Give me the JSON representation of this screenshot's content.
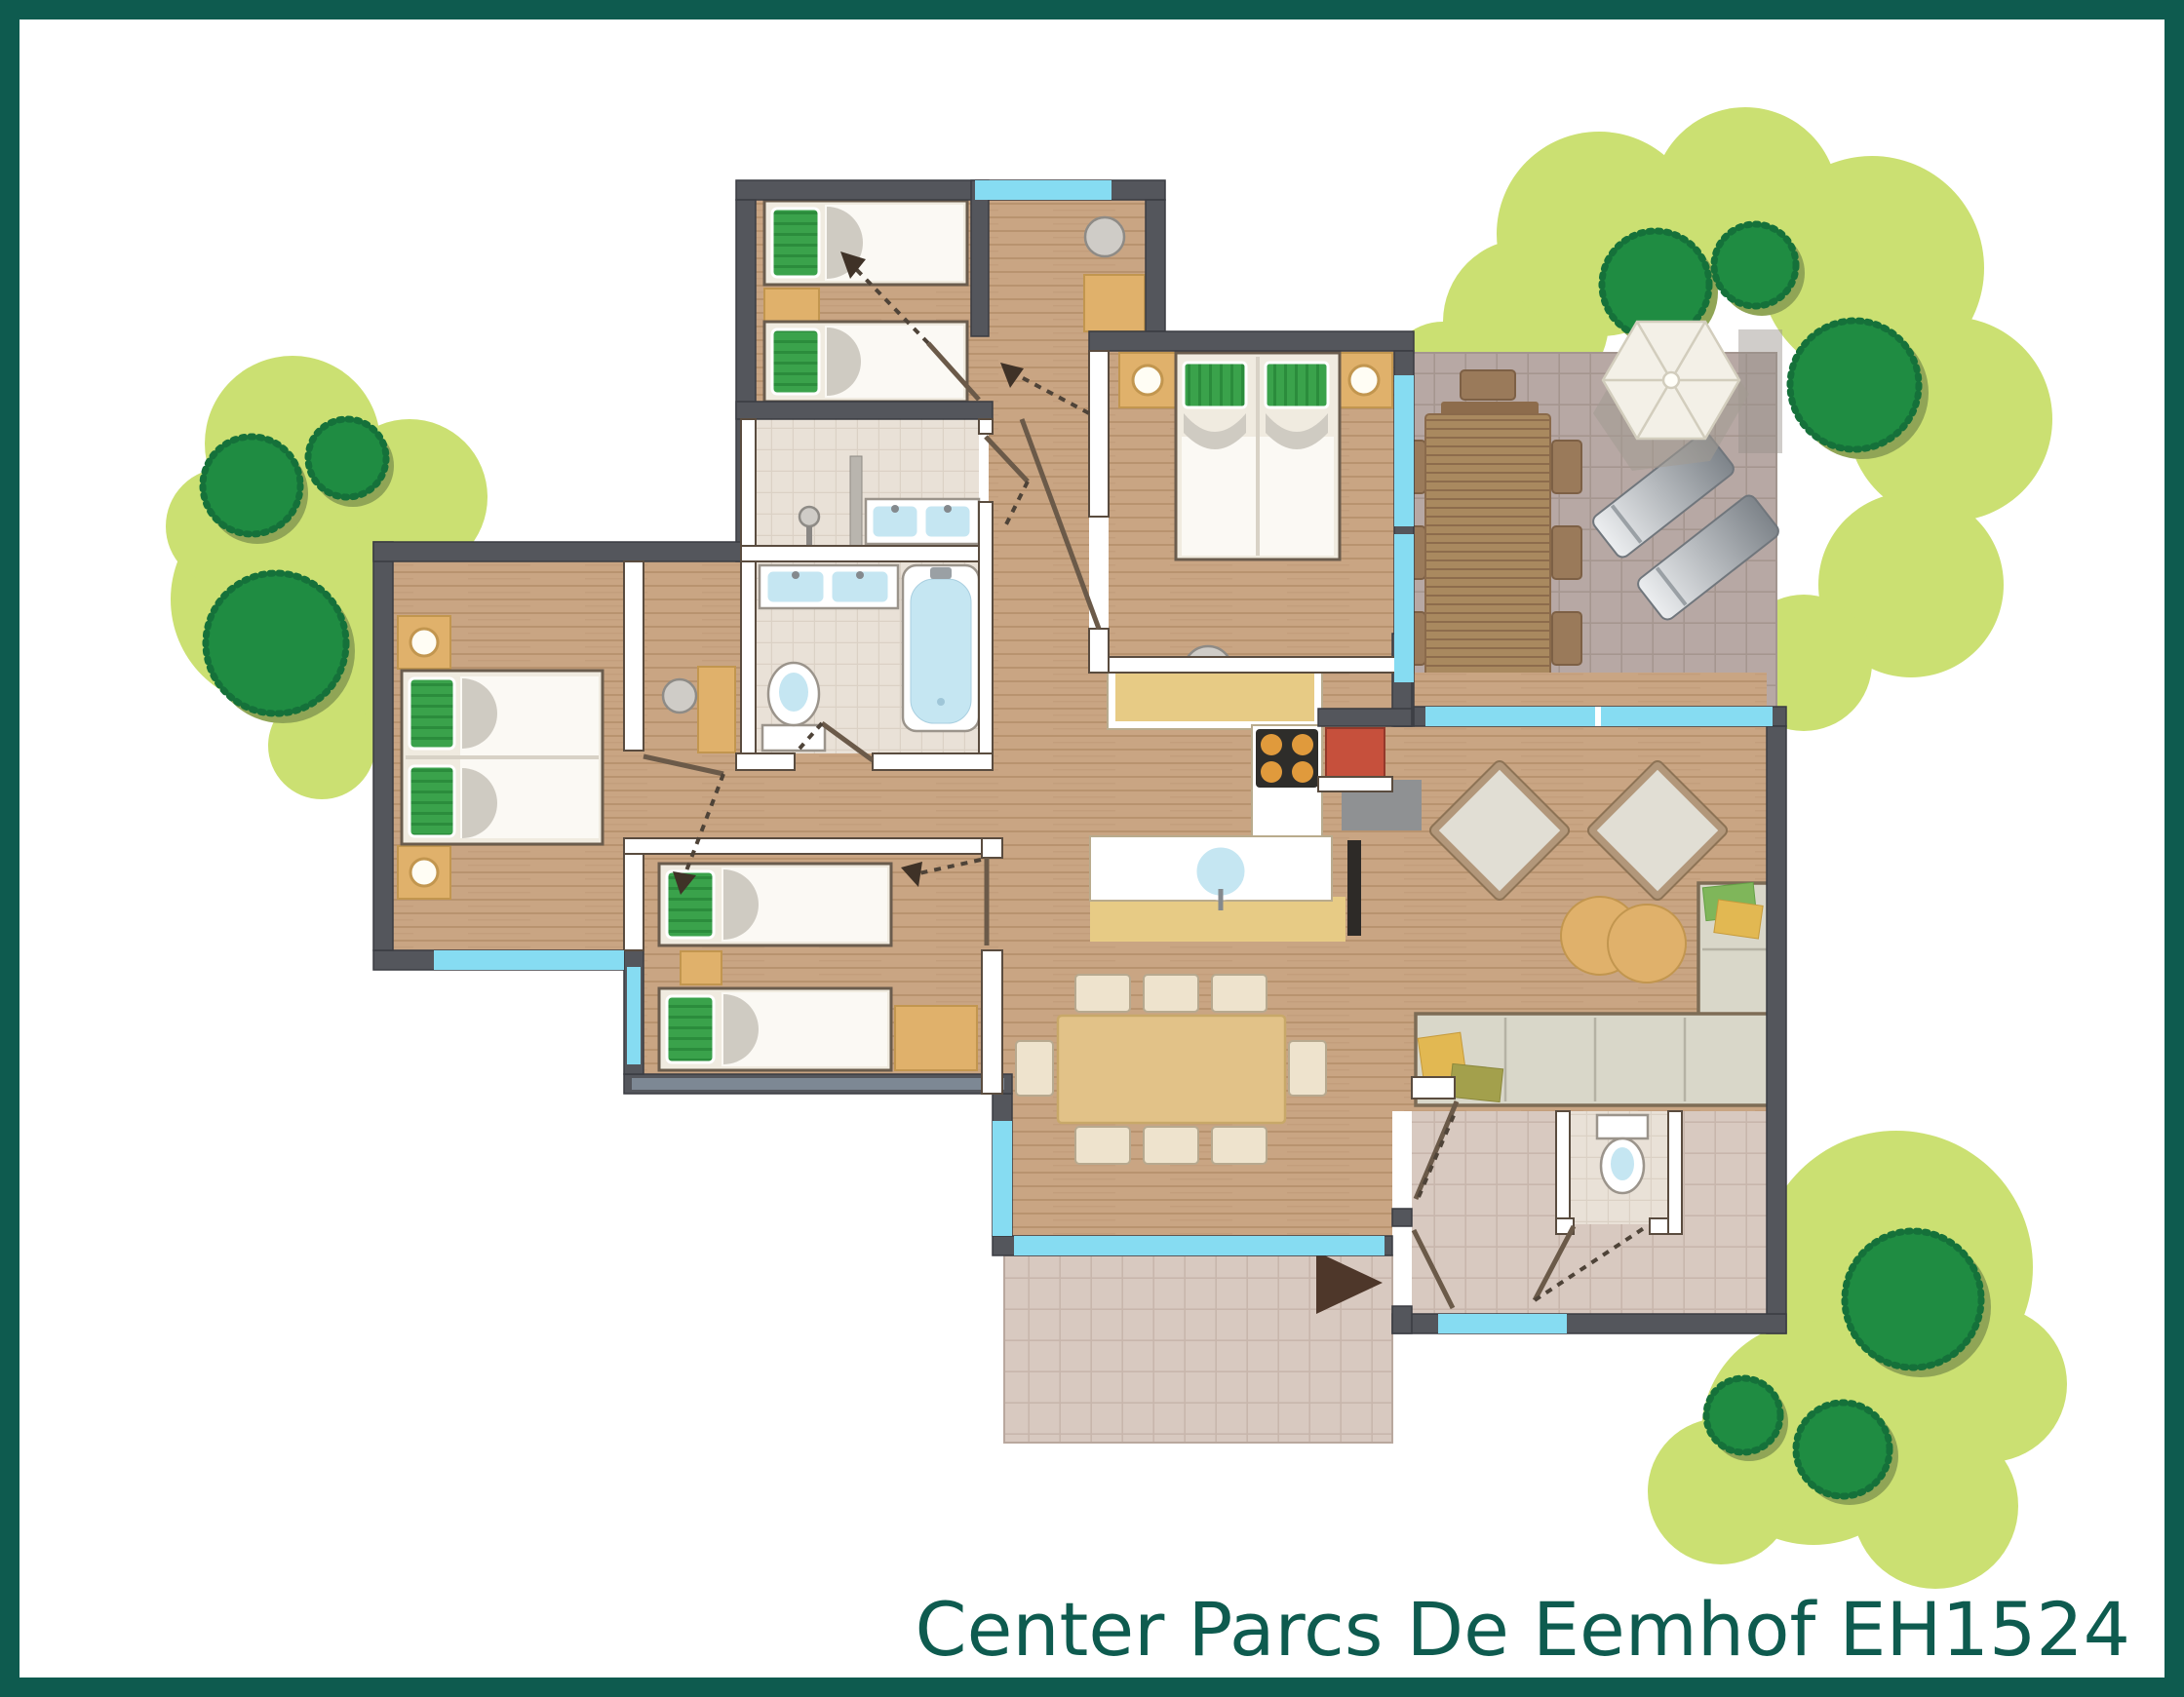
{
  "title": "Center Parcs De Eemhof EH1524",
  "colors": {
    "teal": "#0e5b4f",
    "wall_dark": "#54565c",
    "wall_line": "#3a3c42",
    "wall_white_line": "#5a4c3f",
    "glass": "#86dcf2",
    "wood": "#c9a583",
    "wood_line": "#b8936f",
    "tile_terrace": "#b7a8a4",
    "tile_terrace_line": "#a5968f",
    "tile_hall": "#d8c9c0",
    "tile_hall_line": "#c8b6ac",
    "tile_bath": "#e9e1d7",
    "tile_bath_line": "#dbd1c5",
    "green_light": "#cbe072",
    "green_dark": "#1f8c42",
    "green_edge": "#15713a",
    "green_shadow": "#90a556",
    "bed": "#f0ebe0",
    "bed_line": "#6a5c4d",
    "sheet": "#fbf9f4",
    "fold": "#cfcbc2",
    "pillow": "#3aa24b",
    "pillow_dark": "#2b8c3c",
    "tan": "#e0b16b",
    "tan_line": "#c2964f",
    "table_wood": "#a9895f",
    "table_wood_line": "#8d6c4c",
    "chair_out": "#9a7a5a",
    "dining_table": "#e2c288",
    "chair_in": "#eee3cd",
    "sofa": "#d9d7c9",
    "sofa_frame": "#7d6c55",
    "cushion_yellow": "#e2b852",
    "cushion_olive": "#a3a04c",
    "cushion_green": "#7fb65a",
    "fixture_blue": "#c5e6f2",
    "fixture_line": "#9b948b",
    "steel": "#8f9193",
    "red": "#c6503c",
    "cooktop": "#2e2d2a",
    "burner": "#e09a3c",
    "counter_top": "#e7cb85",
    "arrow": "#4e372a",
    "umbrella": "#f3f0e7",
    "umbrella_line": "#d2cdbd",
    "basin_gray": "#cfccc7"
  },
  "floor_plan": {
    "residence_code": "EH1524",
    "park_name": "Center Parcs De Eemhof",
    "rooms": [
      {
        "id": "bedroom-top-left",
        "furniture": [
          "single-bed",
          "single-bed",
          "nightstand",
          "washbasin",
          "wardrobe"
        ]
      },
      {
        "id": "master-bedroom",
        "furniture": [
          "double-bed",
          "nightstand-with-lamp",
          "nightstand-with-lamp",
          "washbasin"
        ]
      },
      {
        "id": "left-bedroom",
        "furniture": [
          "double-bed",
          "nightstand-with-lamp",
          "nightstand-with-lamp",
          "washbasin",
          "wardrobe"
        ]
      },
      {
        "id": "middle-bedroom",
        "furniture": [
          "single-bed",
          "single-bed",
          "nightstand",
          "wardrobe"
        ]
      },
      {
        "id": "shower-room",
        "furniture": [
          "shower-mixer",
          "glass-screen",
          "double-washbasin"
        ]
      },
      {
        "id": "bathroom",
        "furniture": [
          "double-washbasin",
          "toilet",
          "bathtub"
        ]
      },
      {
        "id": "kitchen",
        "furniture": [
          "wall-counter",
          "cooktop-4-burners",
          "island-counter",
          "round-sink",
          "stove-red",
          "hearth-plate"
        ]
      },
      {
        "id": "living-room",
        "furniture": [
          "armchair",
          "armchair",
          "pouf",
          "pouf",
          "corner-sofa",
          "cushions",
          "tv"
        ]
      },
      {
        "id": "dining-area",
        "furniture": [
          "dining-table",
          "chair",
          "chair",
          "chair",
          "chair",
          "chair",
          "chair",
          "chair",
          "chair"
        ]
      },
      {
        "id": "entrance-hall",
        "furniture": [
          "toilet-room",
          "entrance-door",
          "interior-doors"
        ]
      },
      {
        "id": "terrace",
        "furniture": [
          "garden-table",
          "garden-chairs-8",
          "parasol",
          "sun-lounger",
          "sun-lounger"
        ]
      },
      {
        "id": "entrance-patio",
        "furniture": [
          "entrance-arrow"
        ]
      }
    ],
    "windows_glass_walls": 9,
    "door_swings": 9,
    "garden": {
      "tree_clusters": 3,
      "dark_bushes": 9
    }
  }
}
